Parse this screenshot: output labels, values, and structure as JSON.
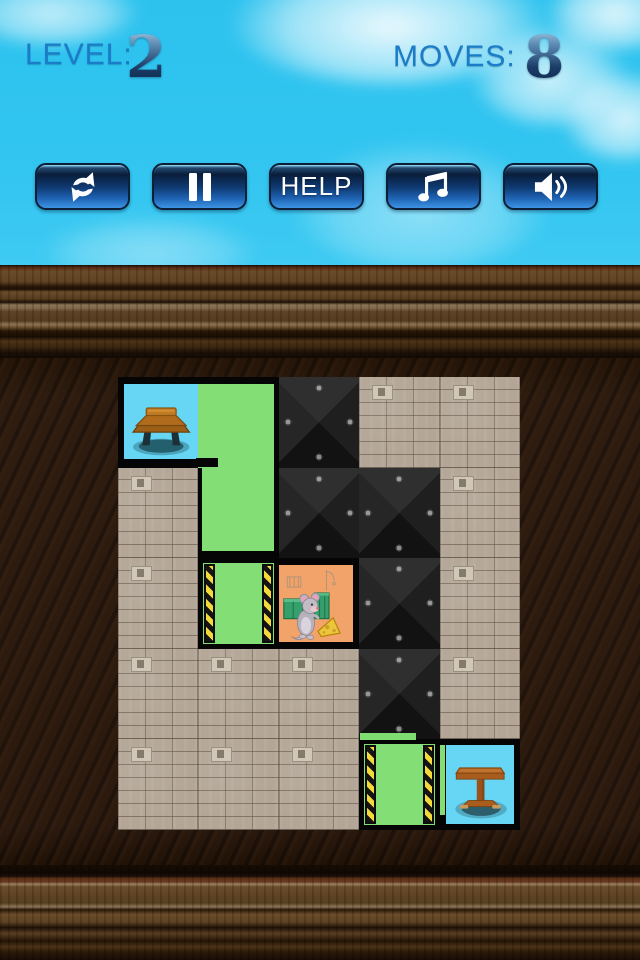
{
  "hud": {
    "level_label": "LEVEL:",
    "level_value": "2",
    "moves_label": "MOVES:",
    "moves_value": "8"
  },
  "toolbar": {
    "restart": {
      "icon": "refresh-icon"
    },
    "pause": {
      "icon": "pause-icon"
    },
    "help": {
      "label": "HELP"
    },
    "music": {
      "icon": "music-note-icon"
    },
    "sound": {
      "icon": "speaker-icon"
    }
  },
  "board": {
    "rows": 5,
    "cols": 5,
    "tiles": [
      [
        "start",
        "greenTop",
        "dark",
        "brick",
        "brick"
      ],
      [
        "brick",
        "greenBot",
        "dark",
        "dark",
        "brick"
      ],
      [
        "brick",
        "door",
        "mouse",
        "dark",
        "brick"
      ],
      [
        "brick",
        "brick",
        "brick",
        "dark",
        "brick"
      ],
      [
        "brick",
        "brick",
        "brick",
        "door",
        "goal"
      ]
    ],
    "tile_names": {
      "start": "start-room-tile",
      "greenTop": "green-block-top",
      "greenBot": "green-block-bottom",
      "dark": "metal-wall-tile",
      "brick": "brick-wall-tile",
      "door": "hazard-door-tile",
      "mouse": "mouse-room-tile",
      "goal": "goal-room-tile"
    },
    "tile_interactable": {
      "start": false,
      "greenTop": true,
      "greenBot": true,
      "dark": false,
      "brick": false,
      "door": true,
      "mouse": false,
      "goal": false
    }
  },
  "colors": {
    "sky": "#31c5f0",
    "hud_blue": "#1b7dc7",
    "button_blue": "#1f64b4",
    "block_green": "#84de76",
    "room_orange": "#f2a369",
    "room_sky": "#66d6f4",
    "hazard_yellow": "#f4d93b",
    "wood_brown": "#5f4324"
  }
}
